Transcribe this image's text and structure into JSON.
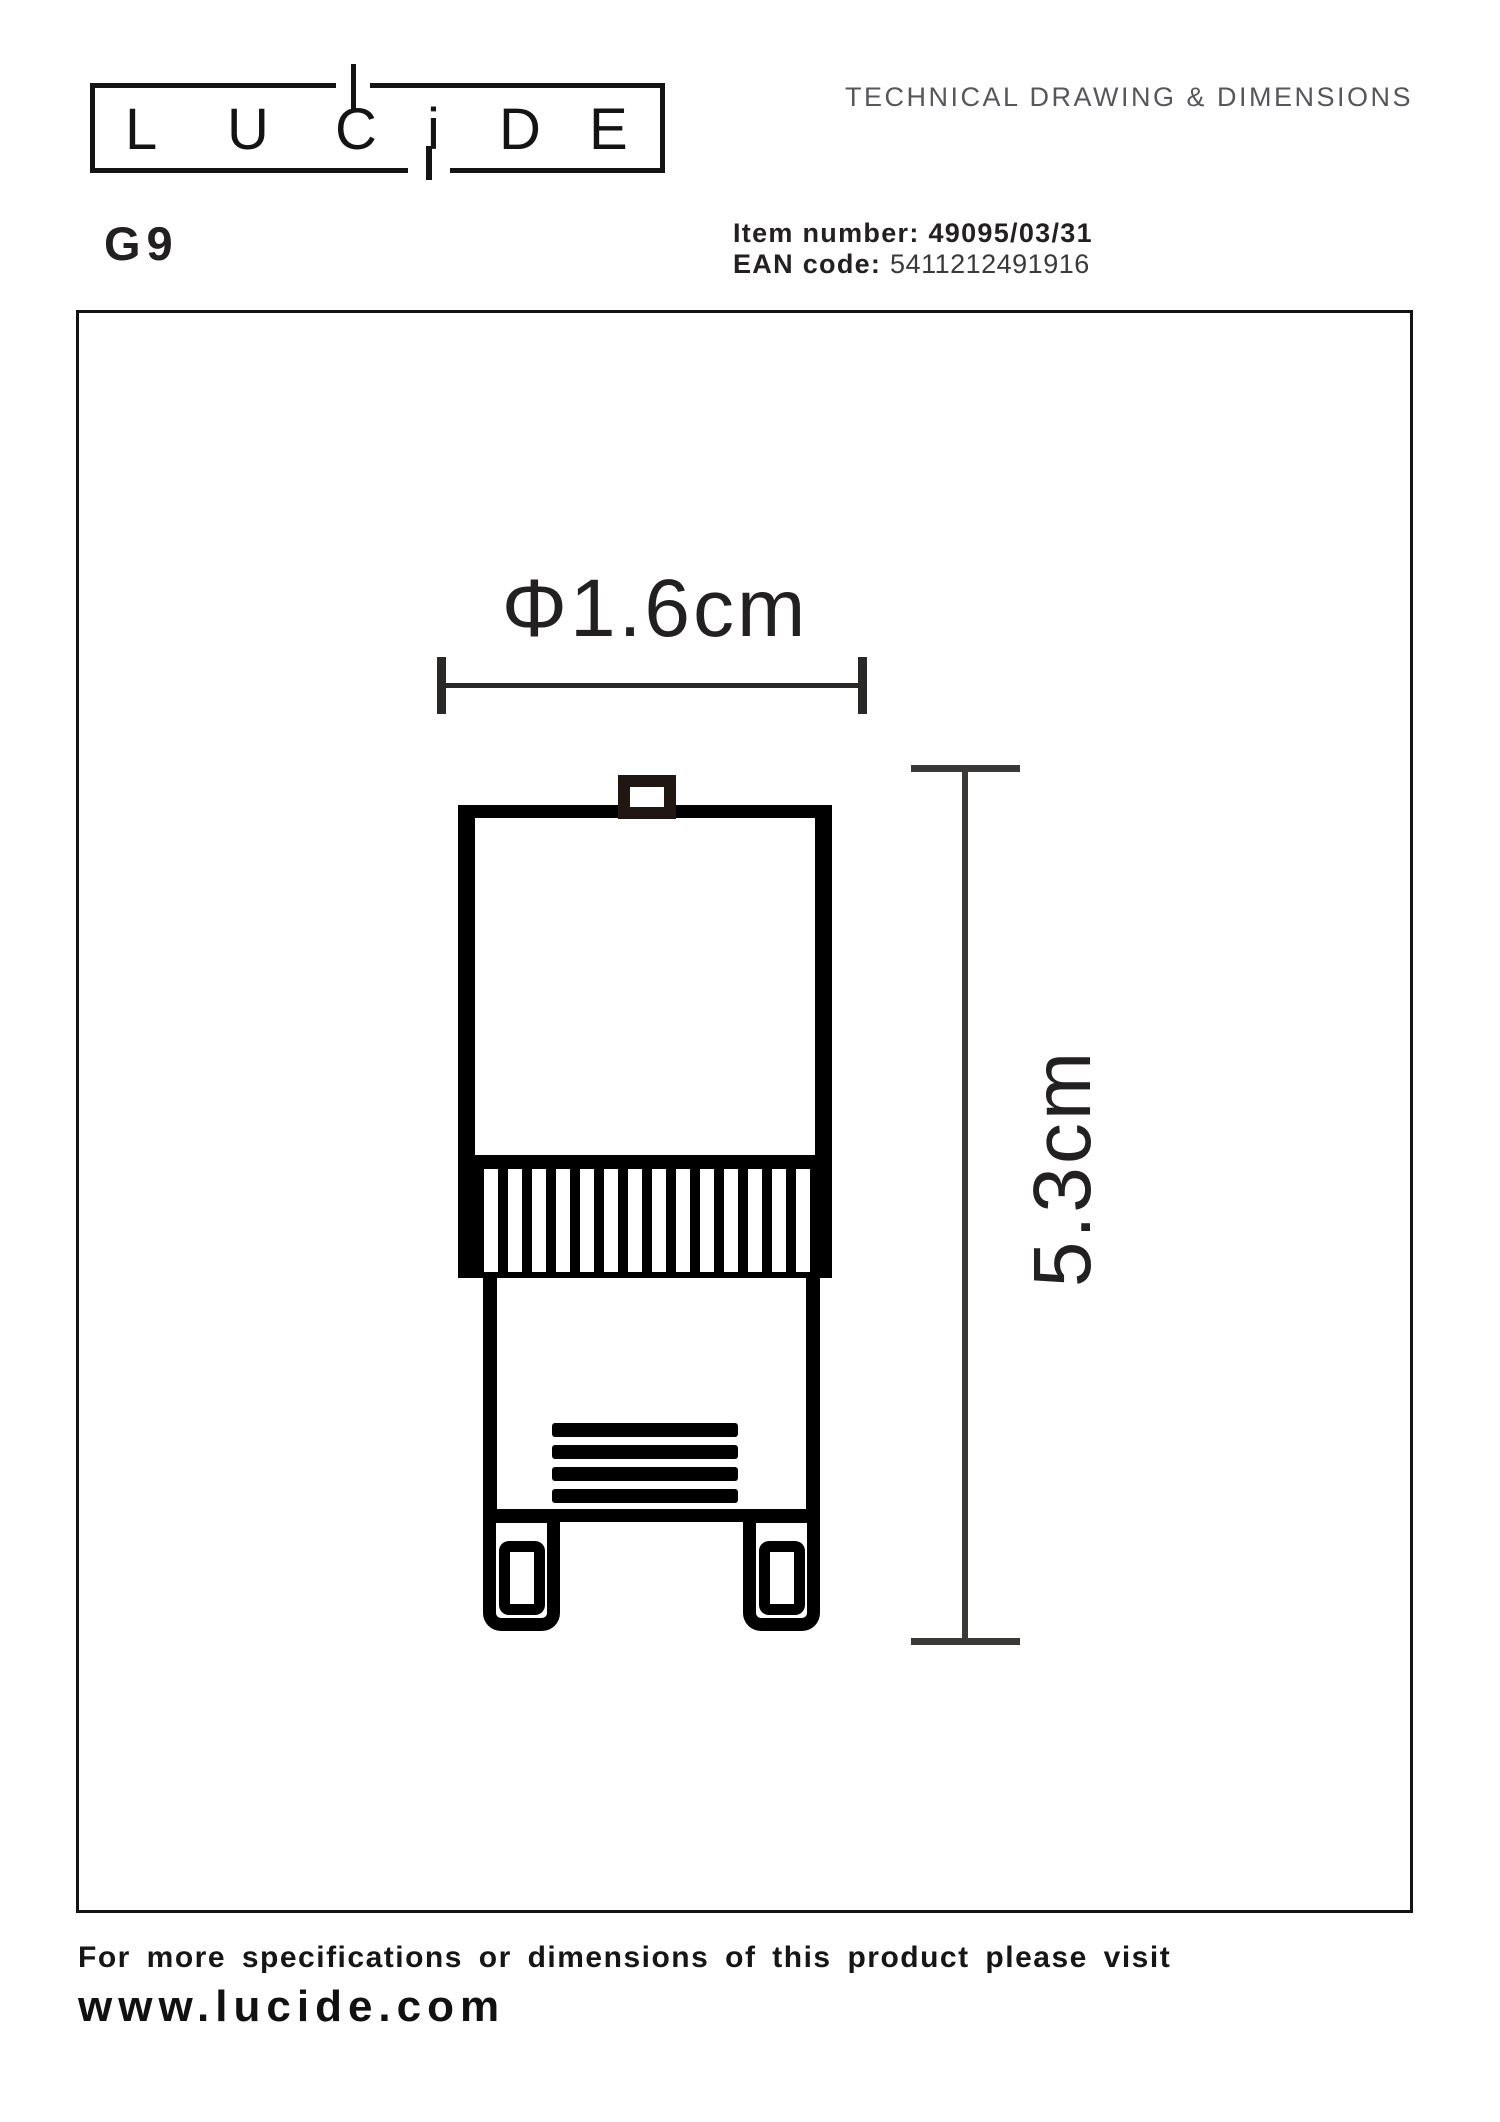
{
  "header": {
    "logo": {
      "letters": [
        "L",
        "U",
        "C",
        "i",
        "D",
        "E"
      ]
    },
    "doc_title": "TECHNICAL DRAWING & DIMENSIONS",
    "product_code": "G9",
    "item": {
      "label": "Item number:",
      "value": "49095/03/31"
    },
    "ean": {
      "label": "EAN code:",
      "value": "5411212491916"
    }
  },
  "drawing": {
    "width_label": "Φ1.6cm",
    "height_label": "5.3cm"
  },
  "footer": {
    "note": "For more specifications or dimensions of this product please visit",
    "url": "www.lucide.com"
  },
  "colors": {
    "ink": "#231F20",
    "muted_title": "#56575B",
    "drawing_stroke": "#000000",
    "dimension_line": "#3A3937"
  }
}
